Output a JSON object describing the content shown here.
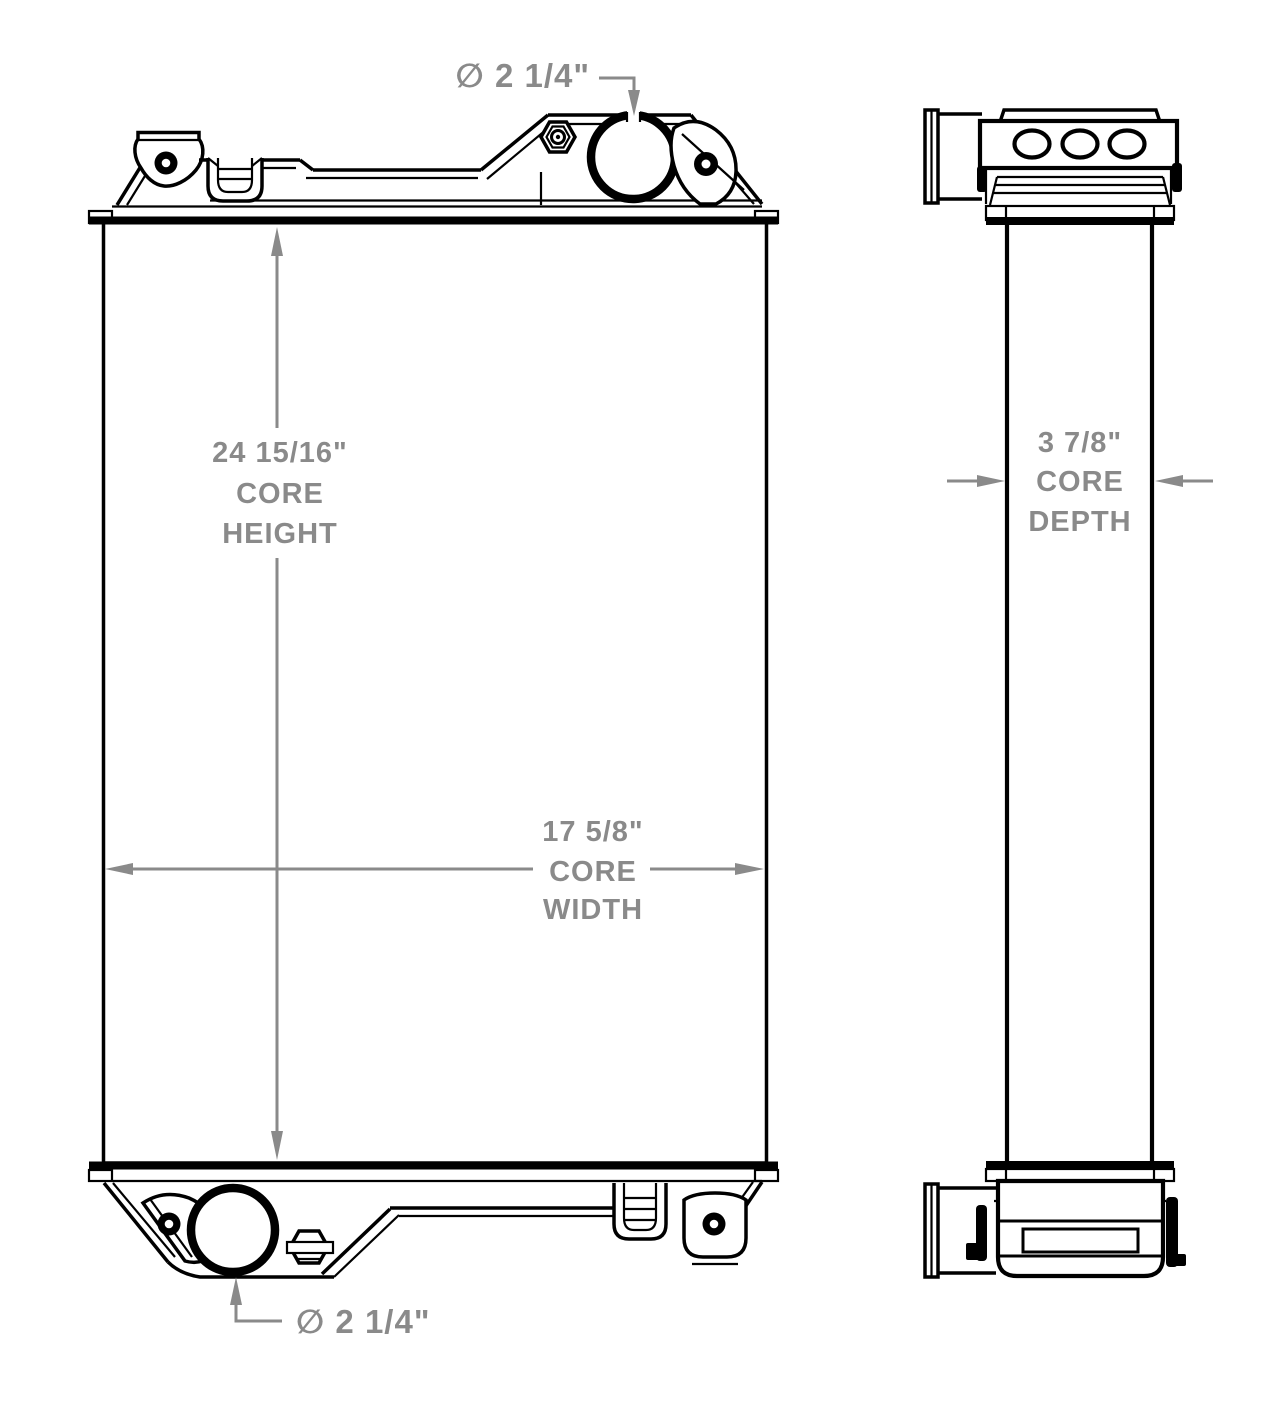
{
  "colors": {
    "outline": "#000000",
    "dimension": "#8a8a8a",
    "background": "#ffffff"
  },
  "dims": {
    "top_port": {
      "text": "∅ 2 1/4\""
    },
    "core_height": {
      "lines": [
        "24 15/16\"",
        "CORE",
        "HEIGHT"
      ]
    },
    "core_width": {
      "lines": [
        "17 5/8\"",
        "CORE",
        "WIDTH"
      ]
    },
    "core_depth": {
      "lines": [
        "3 7/8\"",
        "CORE",
        "DEPTH"
      ]
    },
    "bottom_port": {
      "text": "∅ 2 1/4\""
    }
  }
}
